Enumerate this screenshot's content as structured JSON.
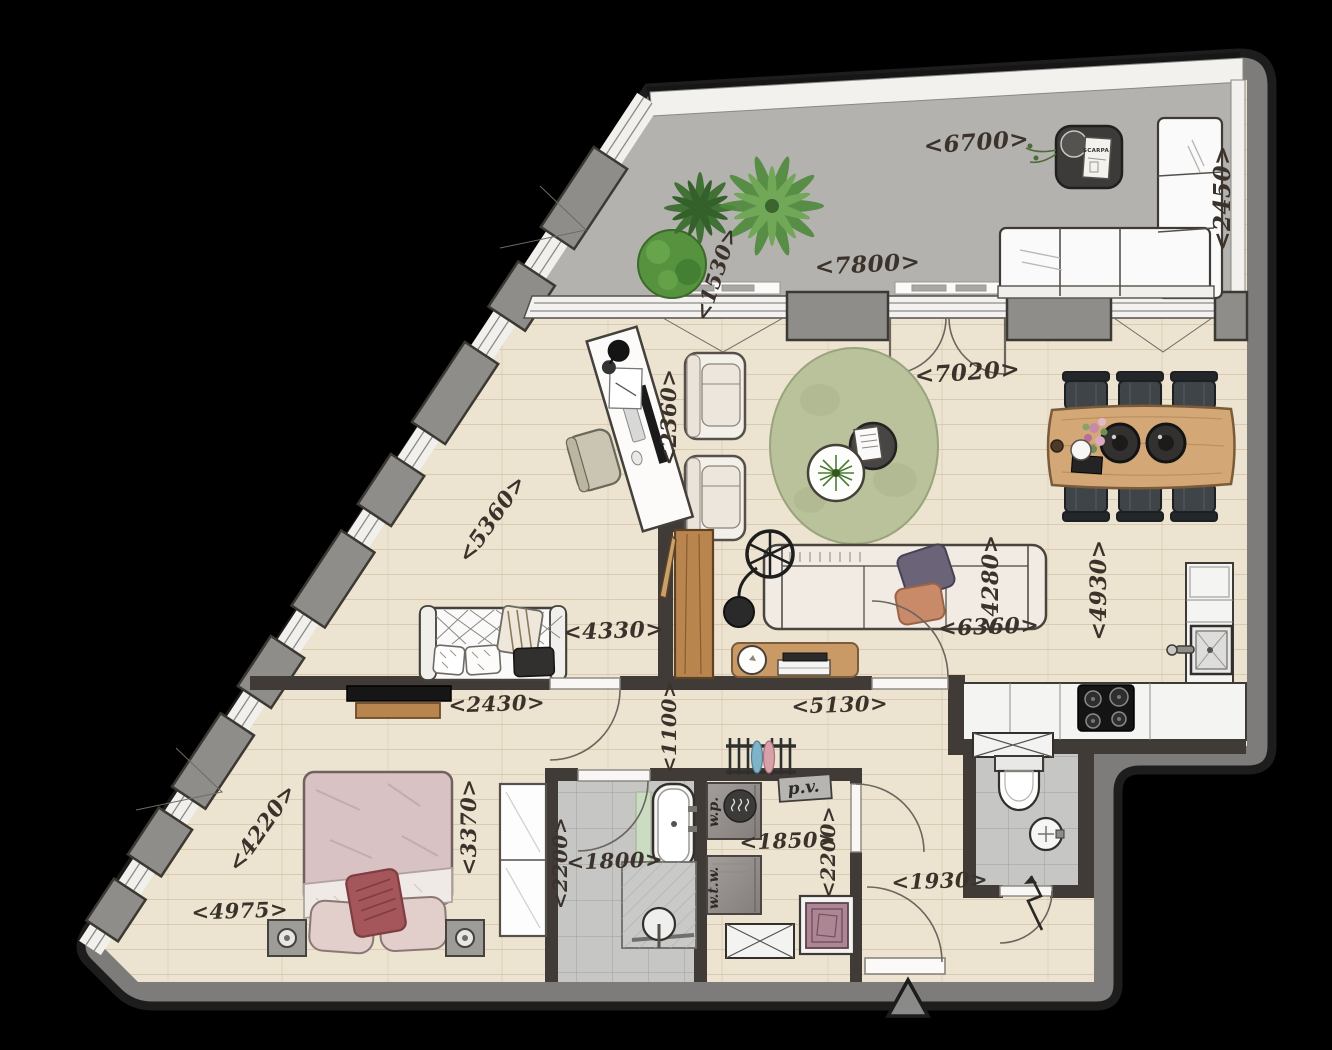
{
  "meta": {
    "kind": "architectural floor plan, hand-drawn style, top view apartment with terrace",
    "units": "millimetres"
  },
  "colors": {
    "background": "#000000",
    "exterior_wall": "#7e7c7a",
    "interior_wall": "#403b36",
    "wood_floor": "#ece3d0",
    "terrace_concrete": "#b4b2af",
    "tile_floor": "#c6c6c5",
    "dimension_text": "#3b332b",
    "rug_green": "#b9c29a",
    "bed_pink": "#d8c2c3",
    "cushion_red": "#a5565a",
    "furniture_wood": "#c89a66",
    "plant_green": "#4e8a3a"
  },
  "dimension_labels": [
    {
      "id": "6700",
      "text": "<6700>",
      "x": 977,
      "y": 150,
      "rot": -4,
      "size": 23
    },
    {
      "id": "2450",
      "text": "<2450>",
      "x": 1230,
      "y": 198,
      "rot": -90,
      "size": 23
    },
    {
      "id": "7800",
      "text": "<7800>",
      "x": 868,
      "y": 272,
      "rot": -3,
      "size": 23
    },
    {
      "id": "1530",
      "text": "<1530>",
      "x": 723,
      "y": 276,
      "rot": -72,
      "size": 21
    },
    {
      "id": "2360",
      "text": "<2360>",
      "x": 676,
      "y": 417,
      "rot": -90,
      "size": 21
    },
    {
      "id": "7020",
      "text": "<7020>",
      "x": 968,
      "y": 380,
      "rot": -4,
      "size": 23
    },
    {
      "id": "5360",
      "text": "<5360>",
      "x": 498,
      "y": 523,
      "rot": -55,
      "size": 22
    },
    {
      "id": "4280",
      "text": "<4280>",
      "x": 998,
      "y": 585,
      "rot": -90,
      "size": 22
    },
    {
      "id": "4930",
      "text": "<4930>",
      "x": 1106,
      "y": 590,
      "rot": -90,
      "size": 22
    },
    {
      "id": "4330",
      "text": "<4330>",
      "x": 614,
      "y": 638,
      "rot": -2,
      "size": 22
    },
    {
      "id": "6360",
      "text": "<6360>",
      "x": 989,
      "y": 634,
      "rot": -2,
      "size": 22
    },
    {
      "id": "2430",
      "text": "<2430>",
      "x": 497,
      "y": 711,
      "rot": -2,
      "size": 21
    },
    {
      "id": "1100",
      "text": "<1100>",
      "x": 676,
      "y": 727,
      "rot": -90,
      "size": 20
    },
    {
      "id": "5130",
      "text": "<5130>",
      "x": 840,
      "y": 712,
      "rot": -2,
      "size": 21
    },
    {
      "id": "4220",
      "text": "<4220>",
      "x": 268,
      "y": 832,
      "rot": -55,
      "size": 22
    },
    {
      "id": "3370",
      "text": "<3370>",
      "x": 476,
      "y": 827,
      "rot": -90,
      "size": 21
    },
    {
      "id": "2200-bath",
      "text": "<2200>",
      "x": 567,
      "y": 863,
      "rot": -90,
      "size": 20
    },
    {
      "id": "1800",
      "text": "<1800>",
      "x": 615,
      "y": 868,
      "rot": -2,
      "size": 21
    },
    {
      "id": "1850",
      "text": "<1850>",
      "x": 788,
      "y": 848,
      "rot": -2,
      "size": 21
    },
    {
      "id": "2200-hall",
      "text": "<2200>",
      "x": 835,
      "y": 852,
      "rot": -90,
      "size": 20
    },
    {
      "id": "1930",
      "text": "<1930>",
      "x": 940,
      "y": 888,
      "rot": -2,
      "size": 21
    },
    {
      "id": "4975",
      "text": "<4975>",
      "x": 240,
      "y": 918,
      "rot": -2,
      "size": 21
    }
  ],
  "equipment_labels": [
    {
      "id": "wp",
      "text": "w.p.",
      "x": 718,
      "y": 812,
      "rot": -90,
      "size": 14,
      "cls": "equip"
    },
    {
      "id": "wtw",
      "text": "w.t.w.",
      "x": 718,
      "y": 888,
      "rot": -90,
      "size": 14,
      "cls": "equip"
    },
    {
      "id": "pv",
      "text": "p.v.",
      "x": 804,
      "y": 793,
      "rot": -6,
      "size": 17,
      "cls": "equip"
    },
    {
      "id": "scarpa",
      "text": "SCARPA",
      "x": 1096,
      "y": 152,
      "rot": 0,
      "size": 5.5,
      "cls": "book"
    }
  ],
  "features": [
    "terrace with L-sofa, coffee table and plants",
    "living room with armchairs, round rug, sofa, arc lamp, desk nook",
    "dining table with six chairs and two pendant lamps",
    "L-shaped kitchen with sink and 4-burner cooktop",
    "hall bench with cushions, tall wooden cabinet, console table",
    "bedroom with double bed, nightstands, wardrobe, wall TV",
    "bathroom with bathtub and walk-in shower",
    "technical room with w.p., w.t.w., p.v. units and washing machine",
    "separate WC with toilet and basin",
    "entrance with door swing, lightning entrance arrow and triangle marker"
  ]
}
